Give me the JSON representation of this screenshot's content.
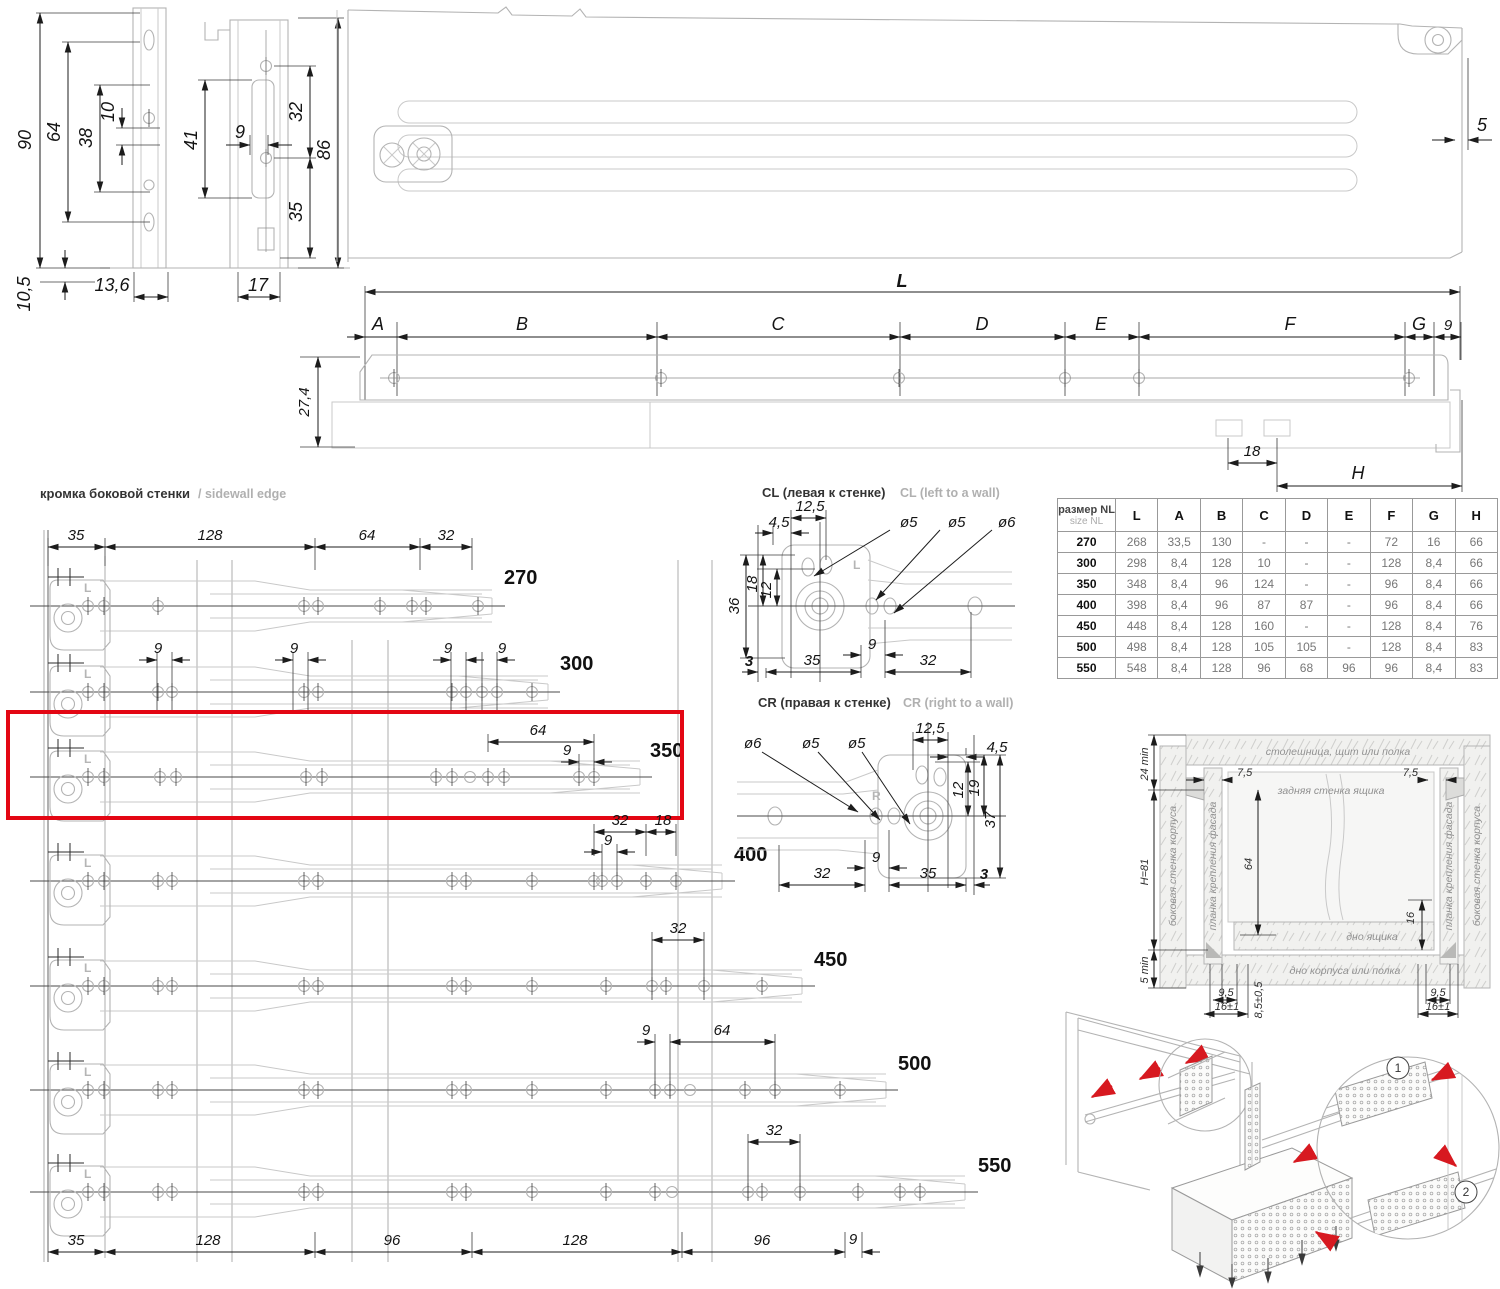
{
  "colors": {
    "red_box": "#e30613",
    "red_arrow": "#d71920",
    "dim_line": "#1c1c1c",
    "part_line": "#b3b3b3"
  },
  "cross_section": {
    "d90": "90",
    "d64": "64",
    "d38": "38",
    "d10": "10",
    "d41": "41",
    "d9": "9",
    "d32": "32",
    "d86": "86",
    "d35": "35",
    "d105": "10,5",
    "d136": "13,6",
    "d17": "17",
    "d5": "5"
  },
  "side_view": {
    "total": "L",
    "seg_a": "A",
    "seg_b": "B",
    "seg_c": "C",
    "seg_d": "D",
    "seg_e": "E",
    "seg_f": "F",
    "seg_g": "G",
    "seg_9": "9",
    "height": "27,4",
    "pitch": "18",
    "rear": "H"
  },
  "sidewall": {
    "title_ru": "кромка боковой стенки",
    "title_en": "/ sidewall edge",
    "mark": "L",
    "top_dims": [
      "35",
      "128",
      "64",
      "32"
    ],
    "bottom_dims": [
      "35",
      "128",
      "96",
      "128",
      "96",
      "9"
    ],
    "rows": [
      {
        "size": "270",
        "dims": []
      },
      {
        "size": "300",
        "dims": [
          "9",
          "9",
          "9",
          "9"
        ]
      },
      {
        "size": "350",
        "dims": [
          "64",
          "9"
        ]
      },
      {
        "size": "400",
        "dims": [
          "32",
          "18",
          "9"
        ]
      },
      {
        "size": "450",
        "dims": [
          "32"
        ]
      },
      {
        "size": "500",
        "dims": [
          "9",
          "64"
        ]
      },
      {
        "size": "550",
        "dims": [
          "32"
        ]
      }
    ]
  },
  "cl": {
    "title_ru": "CL (левая к стенке)",
    "title_en": "CL (left to a wall)",
    "mark": "L",
    "d125": "12,5",
    "d45": "4,5",
    "dia5a": "ø5",
    "dia5b": "ø5",
    "dia6": "ø6",
    "d18": "18",
    "d12": "12",
    "d36": "36",
    "d3": "3",
    "d35": "35",
    "d9": "9",
    "d32": "32"
  },
  "cr": {
    "title_ru": "CR (правая к стенке)",
    "title_en": "CR (right to a wall)",
    "mark": "R",
    "d125": "12,5",
    "d45": "4,5",
    "dia5a": "ø5",
    "dia5b": "ø5",
    "dia6": "ø6",
    "d12": "12",
    "d19": "19",
    "d37": "37",
    "d32": "32",
    "d9": "9",
    "d35": "35",
    "d3": "3"
  },
  "table": {
    "header_ru": "размер NL",
    "header_en": "size NL",
    "columns": [
      "L",
      "A",
      "B",
      "C",
      "D",
      "E",
      "F",
      "G",
      "H"
    ],
    "rows": [
      {
        "size": "270",
        "values": [
          "268",
          "33,5",
          "130",
          "-",
          "-",
          "-",
          "72",
          "16",
          "66"
        ]
      },
      {
        "size": "300",
        "values": [
          "298",
          "8,4",
          "128",
          "10",
          "-",
          "-",
          "128",
          "8,4",
          "66"
        ]
      },
      {
        "size": "350",
        "values": [
          "348",
          "8,4",
          "96",
          "124",
          "-",
          "-",
          "96",
          "8,4",
          "66"
        ]
      },
      {
        "size": "400",
        "values": [
          "398",
          "8,4",
          "96",
          "87",
          "87",
          "-",
          "96",
          "8,4",
          "66"
        ]
      },
      {
        "size": "450",
        "values": [
          "448",
          "8,4",
          "128",
          "160",
          "-",
          "-",
          "128",
          "8,4",
          "76"
        ]
      },
      {
        "size": "500",
        "values": [
          "498",
          "8,4",
          "128",
          "105",
          "105",
          "-",
          "128",
          "8,4",
          "83"
        ]
      },
      {
        "size": "550",
        "values": [
          "548",
          "8,4",
          "128",
          "96",
          "68",
          "96",
          "96",
          "8,4",
          "83"
        ]
      }
    ]
  },
  "install": {
    "top_panel": "столешница, щит или полка",
    "back_wall": "задняя стенка ящика",
    "side_wall_left": "боковая стенка корпуса",
    "side_wall_right": "боковая стенка корпуса",
    "strip_left": "планка крепления фасада",
    "strip_right": "планка крепления фасада",
    "drawer_bottom": "дно ящика",
    "case_bottom": "дно корпуса или полка",
    "d24": "24 min",
    "h81": "H=81",
    "d5min": "5 min",
    "d75l": "7,5",
    "d75r": "7,5",
    "d64": "64",
    "d16": "16",
    "d95l": "9,5",
    "d161l": "16±1",
    "d85": "8,5±0,5",
    "d95r": "9,5",
    "d161r": "16±1"
  },
  "assembly": {
    "step1": "1",
    "step2": "2"
  }
}
